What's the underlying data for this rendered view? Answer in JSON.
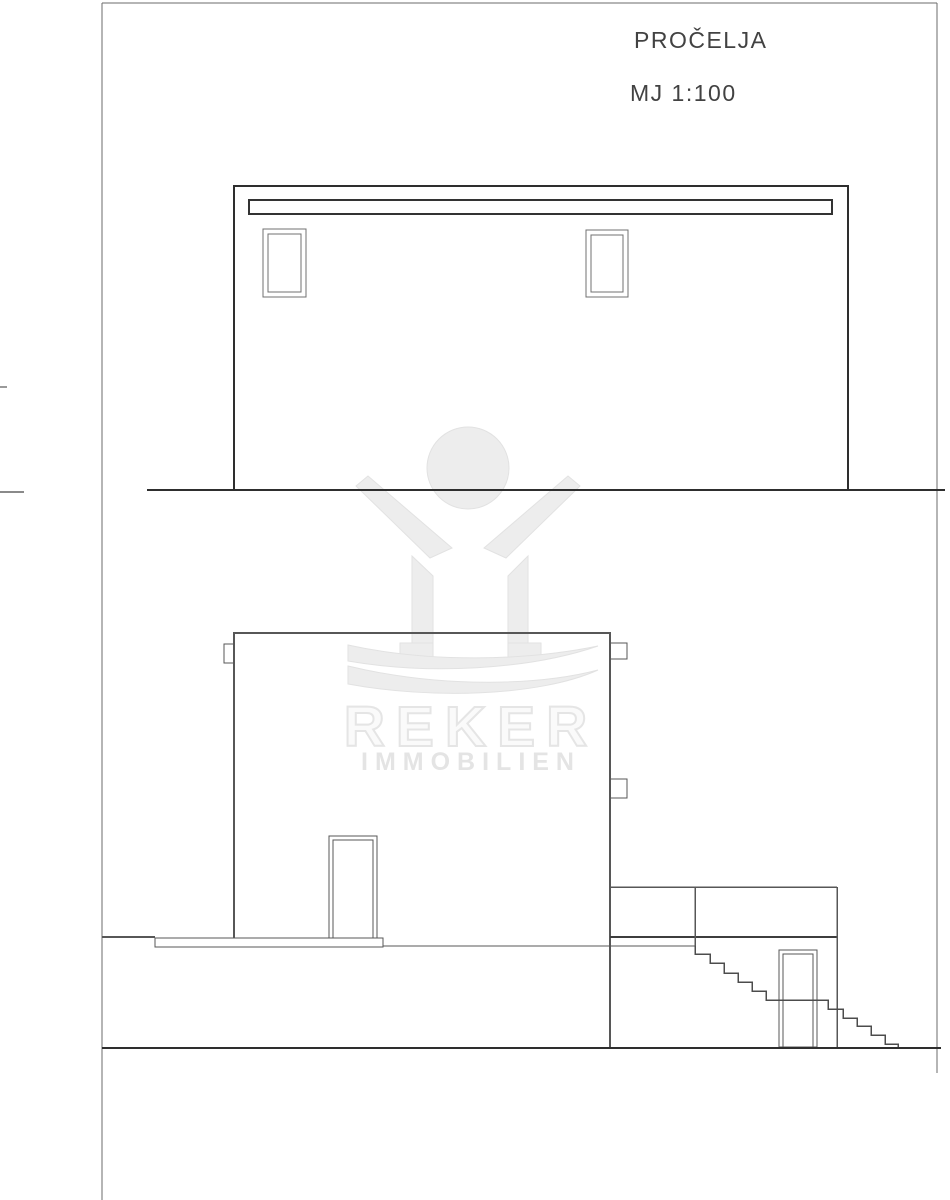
{
  "sheet": {
    "title": "PROČELJA",
    "scale_label": "MJ 1:100",
    "background": "#ffffff"
  },
  "watermark": {
    "brand": "REKER",
    "brand_subtitle": "IMMOBILIEN",
    "fill_color": "#ededed",
    "outline_color": "#e2e2e2"
  },
  "linework": {
    "border_color": "#6b6b6b",
    "heavy_line_color": "#2e2e2e",
    "medium_line_color": "#575757",
    "frame_line_color": "#707070"
  }
}
